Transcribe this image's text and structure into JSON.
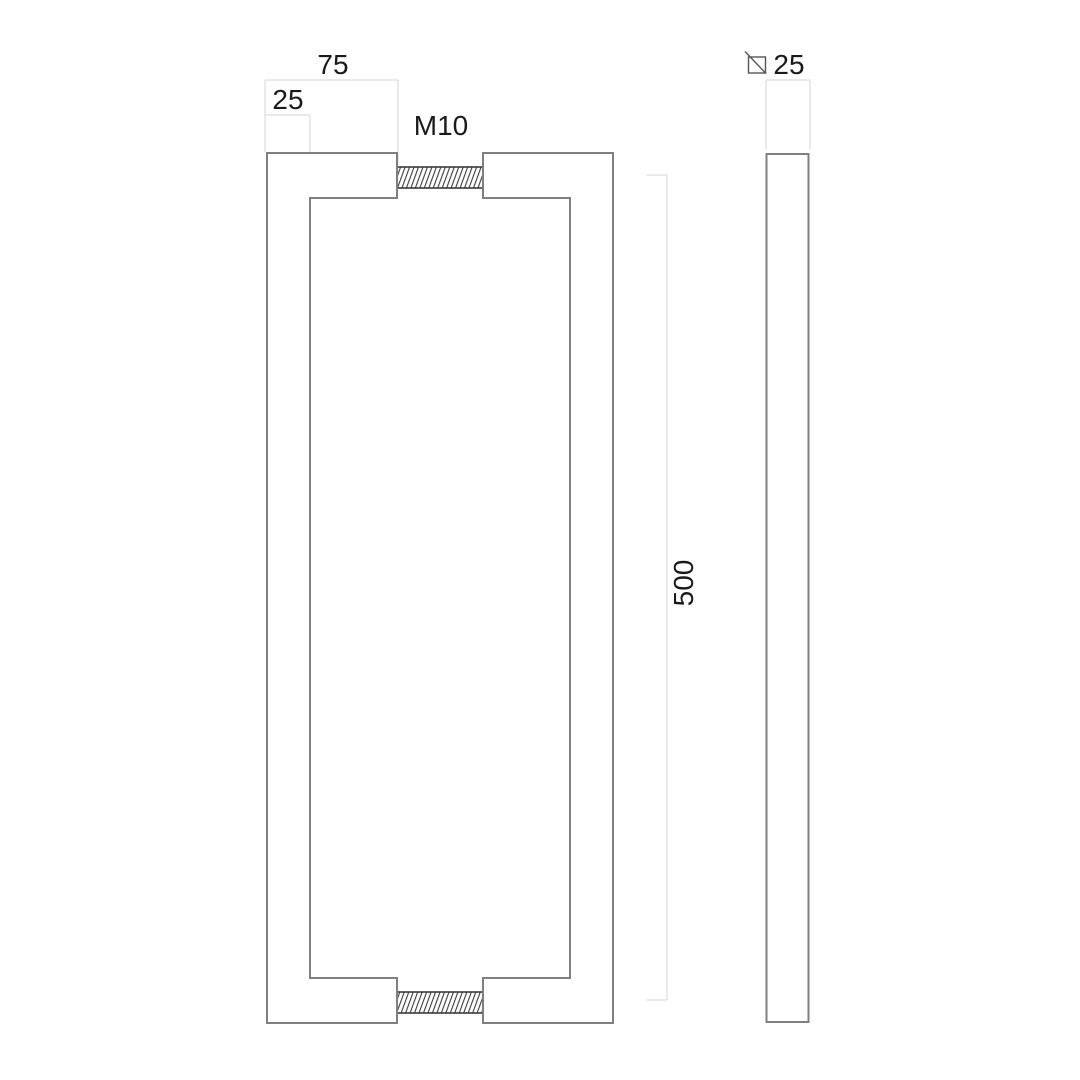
{
  "drawing": {
    "kind": "door-pull-handle-technical-drawing",
    "front_view": {
      "dim_projection": "75",
      "dim_profile": "25",
      "thread_label": "M10",
      "dim_center_distance": "500"
    },
    "side_view": {
      "dim_square_section": "25",
      "icon": "square-section-symbol"
    },
    "colors": {
      "background": "#ffffff",
      "outline": "#7f7f7f",
      "thread": "#3a3a3a",
      "dimension_line": "#e2e2e2",
      "symbol": "#555555",
      "label_text": "#1a1a1a"
    }
  }
}
